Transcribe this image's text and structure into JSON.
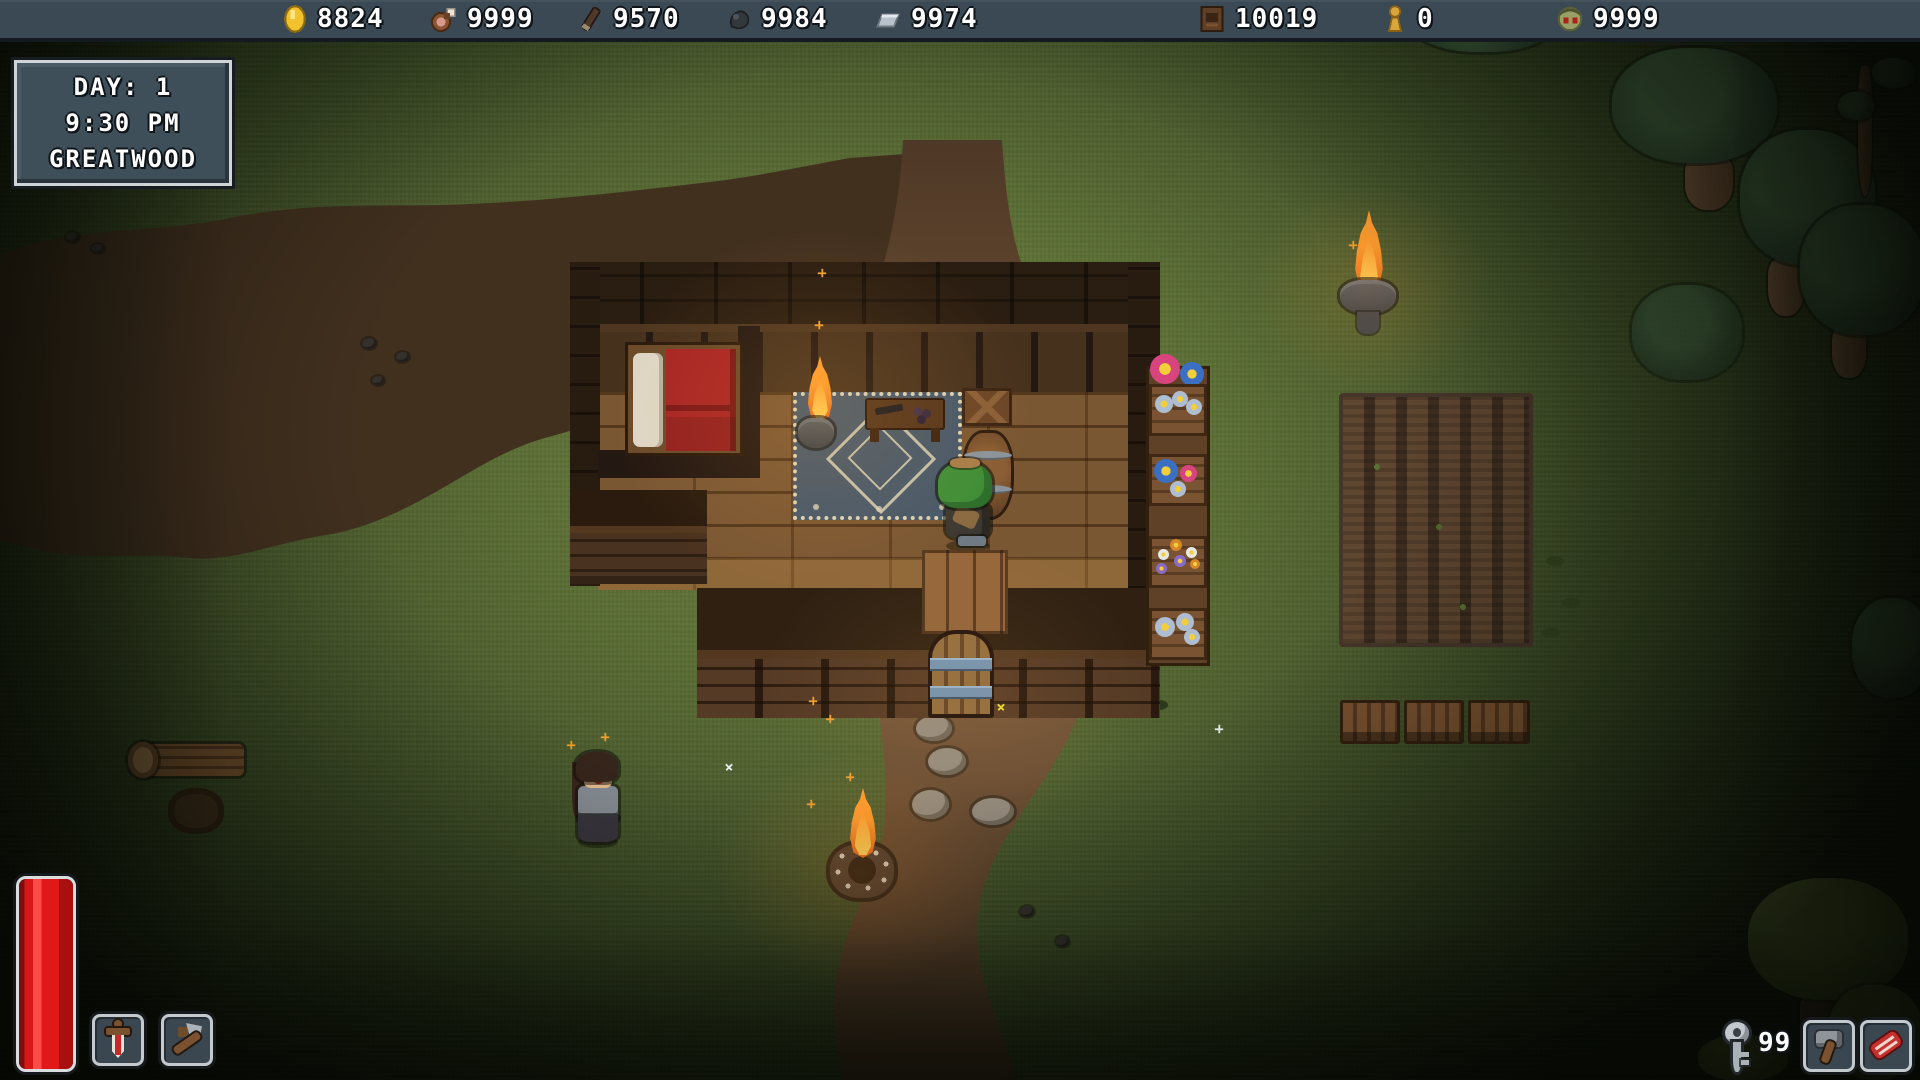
{
  "hud": {
    "top_bar": {
      "resources": [
        {
          "name": "coins",
          "icon": "gold-coin-icon",
          "value": "8824"
        },
        {
          "name": "food",
          "icon": "drumstick-icon",
          "value": "9999"
        },
        {
          "name": "wood",
          "icon": "wood-stick-icon",
          "value": "9570"
        },
        {
          "name": "stone",
          "icon": "stone-icon",
          "value": "9984"
        },
        {
          "name": "iron",
          "icon": "iron-ingot-icon",
          "value": "9974"
        },
        {
          "name": "crates",
          "icon": "crate-icon",
          "value": "10019"
        },
        {
          "name": "idols",
          "icon": "gold-idol-icon",
          "value": "0"
        },
        {
          "name": "zombie-heads",
          "icon": "zombie-head-icon",
          "value": "9999"
        }
      ]
    },
    "day_box": {
      "day": "DAY: 1",
      "time": "9:30 PM",
      "location": "GREATWOOD"
    },
    "health_bar": {
      "percent": 100
    },
    "hotbar_left": {
      "slot1": "sword",
      "slot2": "axe-tool"
    },
    "bottom_right": {
      "key_count": "99",
      "slot1": "stone-hammer",
      "slot2": "raw-meat"
    }
  },
  "world": {
    "scene": "top-down forest clearing at night with wooden cabin, dirt path, farm plot, flower stand, campfire, torch, player in green hood, villager npc",
    "objects": [
      "cabin",
      "bed",
      "rug",
      "table",
      "indoor-brazier",
      "crate",
      "barrel",
      "door",
      "flower-stand",
      "farm-plot",
      "wood-tables",
      "torch-brazier",
      "campfire",
      "stepping-stones",
      "log",
      "stump",
      "trees",
      "player",
      "npc"
    ]
  },
  "palette": {
    "hud-bg": "#3a4953",
    "hud-border": "#cfd4d6",
    "hud-dark": "#141b20",
    "health-red": "#e01818",
    "grass-lit": "#6f8142",
    "grass-dark": "#17200f",
    "dirt": "#6b4e33",
    "dirt-dark": "#42301f",
    "wood-dark": "#2a1d11",
    "wood-mid": "#4e3421",
    "wood-light": "#8a5f38",
    "flame-core": "#ffd75a",
    "flame-mid": "#ff9c2e",
    "flame-outer": "#e8661a",
    "rug-blue": "#46586a",
    "rug-cream": "#d9d2b6"
  }
}
